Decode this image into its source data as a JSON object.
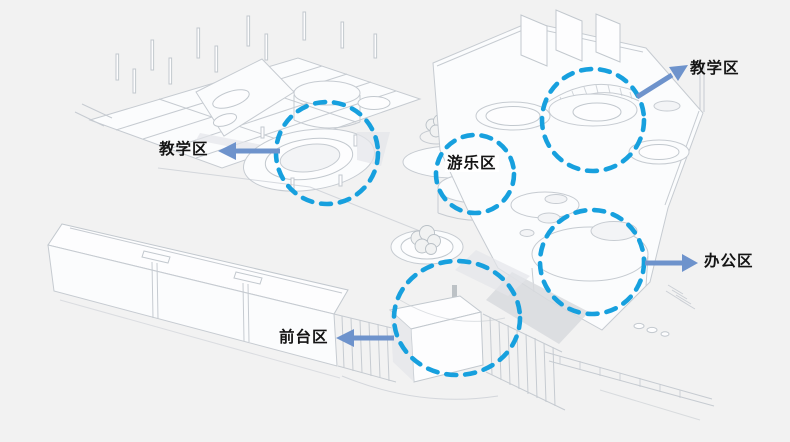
{
  "theme": {
    "circle_color": "#17a0de",
    "arrow_color": "#6e93cc",
    "label_color": "#141414",
    "background": "#f2f2f2",
    "drawing_line_color": "#c6cbd1"
  },
  "diagram": {
    "type": "annotated architectural axonometric drawing",
    "subject": "kindergarten building zoning diagram"
  },
  "annotations": {
    "zones": [
      {
        "id": "teaching-left",
        "label": "教学区"
      },
      {
        "id": "teaching-right",
        "label": "教学区"
      },
      {
        "id": "play",
        "label": "游乐区"
      },
      {
        "id": "office",
        "label": "办公区"
      },
      {
        "id": "reception",
        "label": "前台区"
      }
    ]
  }
}
